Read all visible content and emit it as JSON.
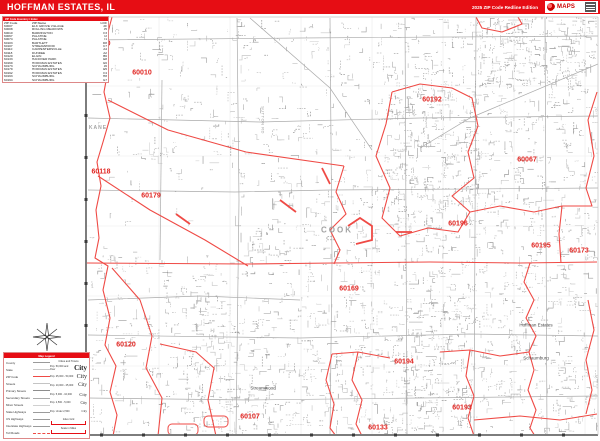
{
  "header": {
    "title": "HOFFMAN ESTATES, IL",
    "edition": "2025 ZIP Code Redline Edition",
    "logo_text": "MAPS"
  },
  "zip_table": {
    "strip_label": "ZIP Code Inventory / Index",
    "columns": [
      "ZIP Code",
      "ZIP Name",
      "LOC"
    ],
    "rows": [
      [
        "60007",
        "ELK GROVE VILLAGE",
        "2F"
      ],
      [
        "60008",
        "ROLLING MEADOWS",
        "J5"
      ],
      [
        "60010",
        "BARRINGTON",
        "F3"
      ],
      [
        "60067",
        "PALATINE",
        "I2"
      ],
      [
        "60074",
        "PALATINE",
        "I1"
      ],
      [
        "60103",
        "BARTLETT",
        "D8"
      ],
      [
        "60107",
        "STREAMWOOD",
        "C7"
      ],
      [
        "60110",
        "CARPENTERSVILLE",
        "A4"
      ],
      [
        "60118",
        "DUNDEE",
        "A2"
      ],
      [
        "60120",
        "ELGIN",
        "B6"
      ],
      [
        "60133",
        "HANOVER PARK",
        "E8"
      ],
      [
        "60169",
        "HOFFMAN ESTATES",
        "G6"
      ],
      [
        "60173",
        "SCHAUMBURG",
        "J6"
      ],
      [
        "60179",
        "HOFFMAN ESTATES",
        "E5"
      ],
      [
        "60192",
        "HOFFMAN ESTATES",
        "F4"
      ],
      [
        "60193",
        "SCHAUMBURG",
        "H8"
      ],
      [
        "60194",
        "SCHAUMBURG",
        "G7"
      ]
    ]
  },
  "legend": {
    "strip_label": "Map Legend",
    "line_items": [
      {
        "label": "County",
        "style": "county"
      },
      {
        "label": "State",
        "style": "state"
      },
      {
        "label": "ZIP Code",
        "style": "zip"
      },
      {
        "label": "Streets",
        "style": "street"
      },
      {
        "label": "Primary Streets",
        "style": "primary"
      },
      {
        "label": "Secondary Streets",
        "style": "secondary"
      },
      {
        "label": "Minor Streets",
        "style": "minor"
      },
      {
        "label": "State Highways",
        "style": "statehwy"
      },
      {
        "label": "US Highways",
        "style": "ushwy"
      },
      {
        "label": "Interstate Highways",
        "style": "interstate"
      },
      {
        "label": "Toll Roads",
        "style": "toll"
      }
    ],
    "city_header": "Cities and Towns",
    "city_sizes": [
      {
        "label": "Pop. 50,000 and Over",
        "sample": "City",
        "size": 7,
        "bold": true
      },
      {
        "label": "Pop. 25,000 - 50,000",
        "sample": "City",
        "size": 6,
        "bold": false
      },
      {
        "label": "Pop. 10,000 - 25,000",
        "sample": "City",
        "size": 5.2,
        "bold": false
      },
      {
        "label": "Pop. 5,000 - 10,000",
        "sample": "City",
        "size": 4.4,
        "bold": false
      },
      {
        "label": "Pop. 2,500 - 5,000",
        "sample": "City",
        "size": 3.8,
        "bold": false
      },
      {
        "label": "Pop. Under 2,500",
        "sample": "City",
        "size": 3.2,
        "bold": false
      }
    ],
    "scale_bars": [
      {
        "label": "Index Grid"
      },
      {
        "label": "Scale in Miles"
      }
    ]
  },
  "map": {
    "zip_labels": [
      {
        "text": "60110",
        "x": 101,
        "y": 44
      },
      {
        "text": "60010",
        "x": 142,
        "y": 73
      },
      {
        "text": "60192",
        "x": 432,
        "y": 100
      },
      {
        "text": "60067",
        "x": 527,
        "y": 160
      },
      {
        "text": "60118",
        "x": 101,
        "y": 172
      },
      {
        "text": "60179",
        "x": 151,
        "y": 196
      },
      {
        "text": "60196",
        "x": 458,
        "y": 224
      },
      {
        "text": "60195",
        "x": 541,
        "y": 246
      },
      {
        "text": "60173",
        "x": 579,
        "y": 251
      },
      {
        "text": "60169",
        "x": 349,
        "y": 289
      },
      {
        "text": "60120",
        "x": 126,
        "y": 345
      },
      {
        "text": "60194",
        "x": 404,
        "y": 362
      },
      {
        "text": "60193",
        "x": 462,
        "y": 408
      },
      {
        "text": "60107",
        "x": 250,
        "y": 417
      },
      {
        "text": "60133",
        "x": 378,
        "y": 428
      }
    ],
    "county_labels": [
      {
        "text": "KANE",
        "x": 98,
        "y": 128,
        "small": true
      },
      {
        "text": "COOK",
        "x": 337,
        "y": 230,
        "small": false
      }
    ],
    "place_labels": [
      {
        "text": "Hoffman Estates",
        "x": 536,
        "y": 325
      },
      {
        "text": "Schaumburg",
        "x": 536,
        "y": 358
      },
      {
        "text": "Streamwood",
        "x": 263,
        "y": 388
      }
    ],
    "road_labels": [
      {
        "text": "SUTTON RD",
        "x": 263,
        "y": 120
      }
    ]
  },
  "colors": {
    "accent": "#e60d14",
    "boundary": "#ef4a45",
    "zip_label": "#e02420",
    "street_light": "#c7c7c7",
    "street_mid": "#b3b3b3",
    "street_dark": "#9b9b9b",
    "neatline": "#7d7d7d"
  }
}
